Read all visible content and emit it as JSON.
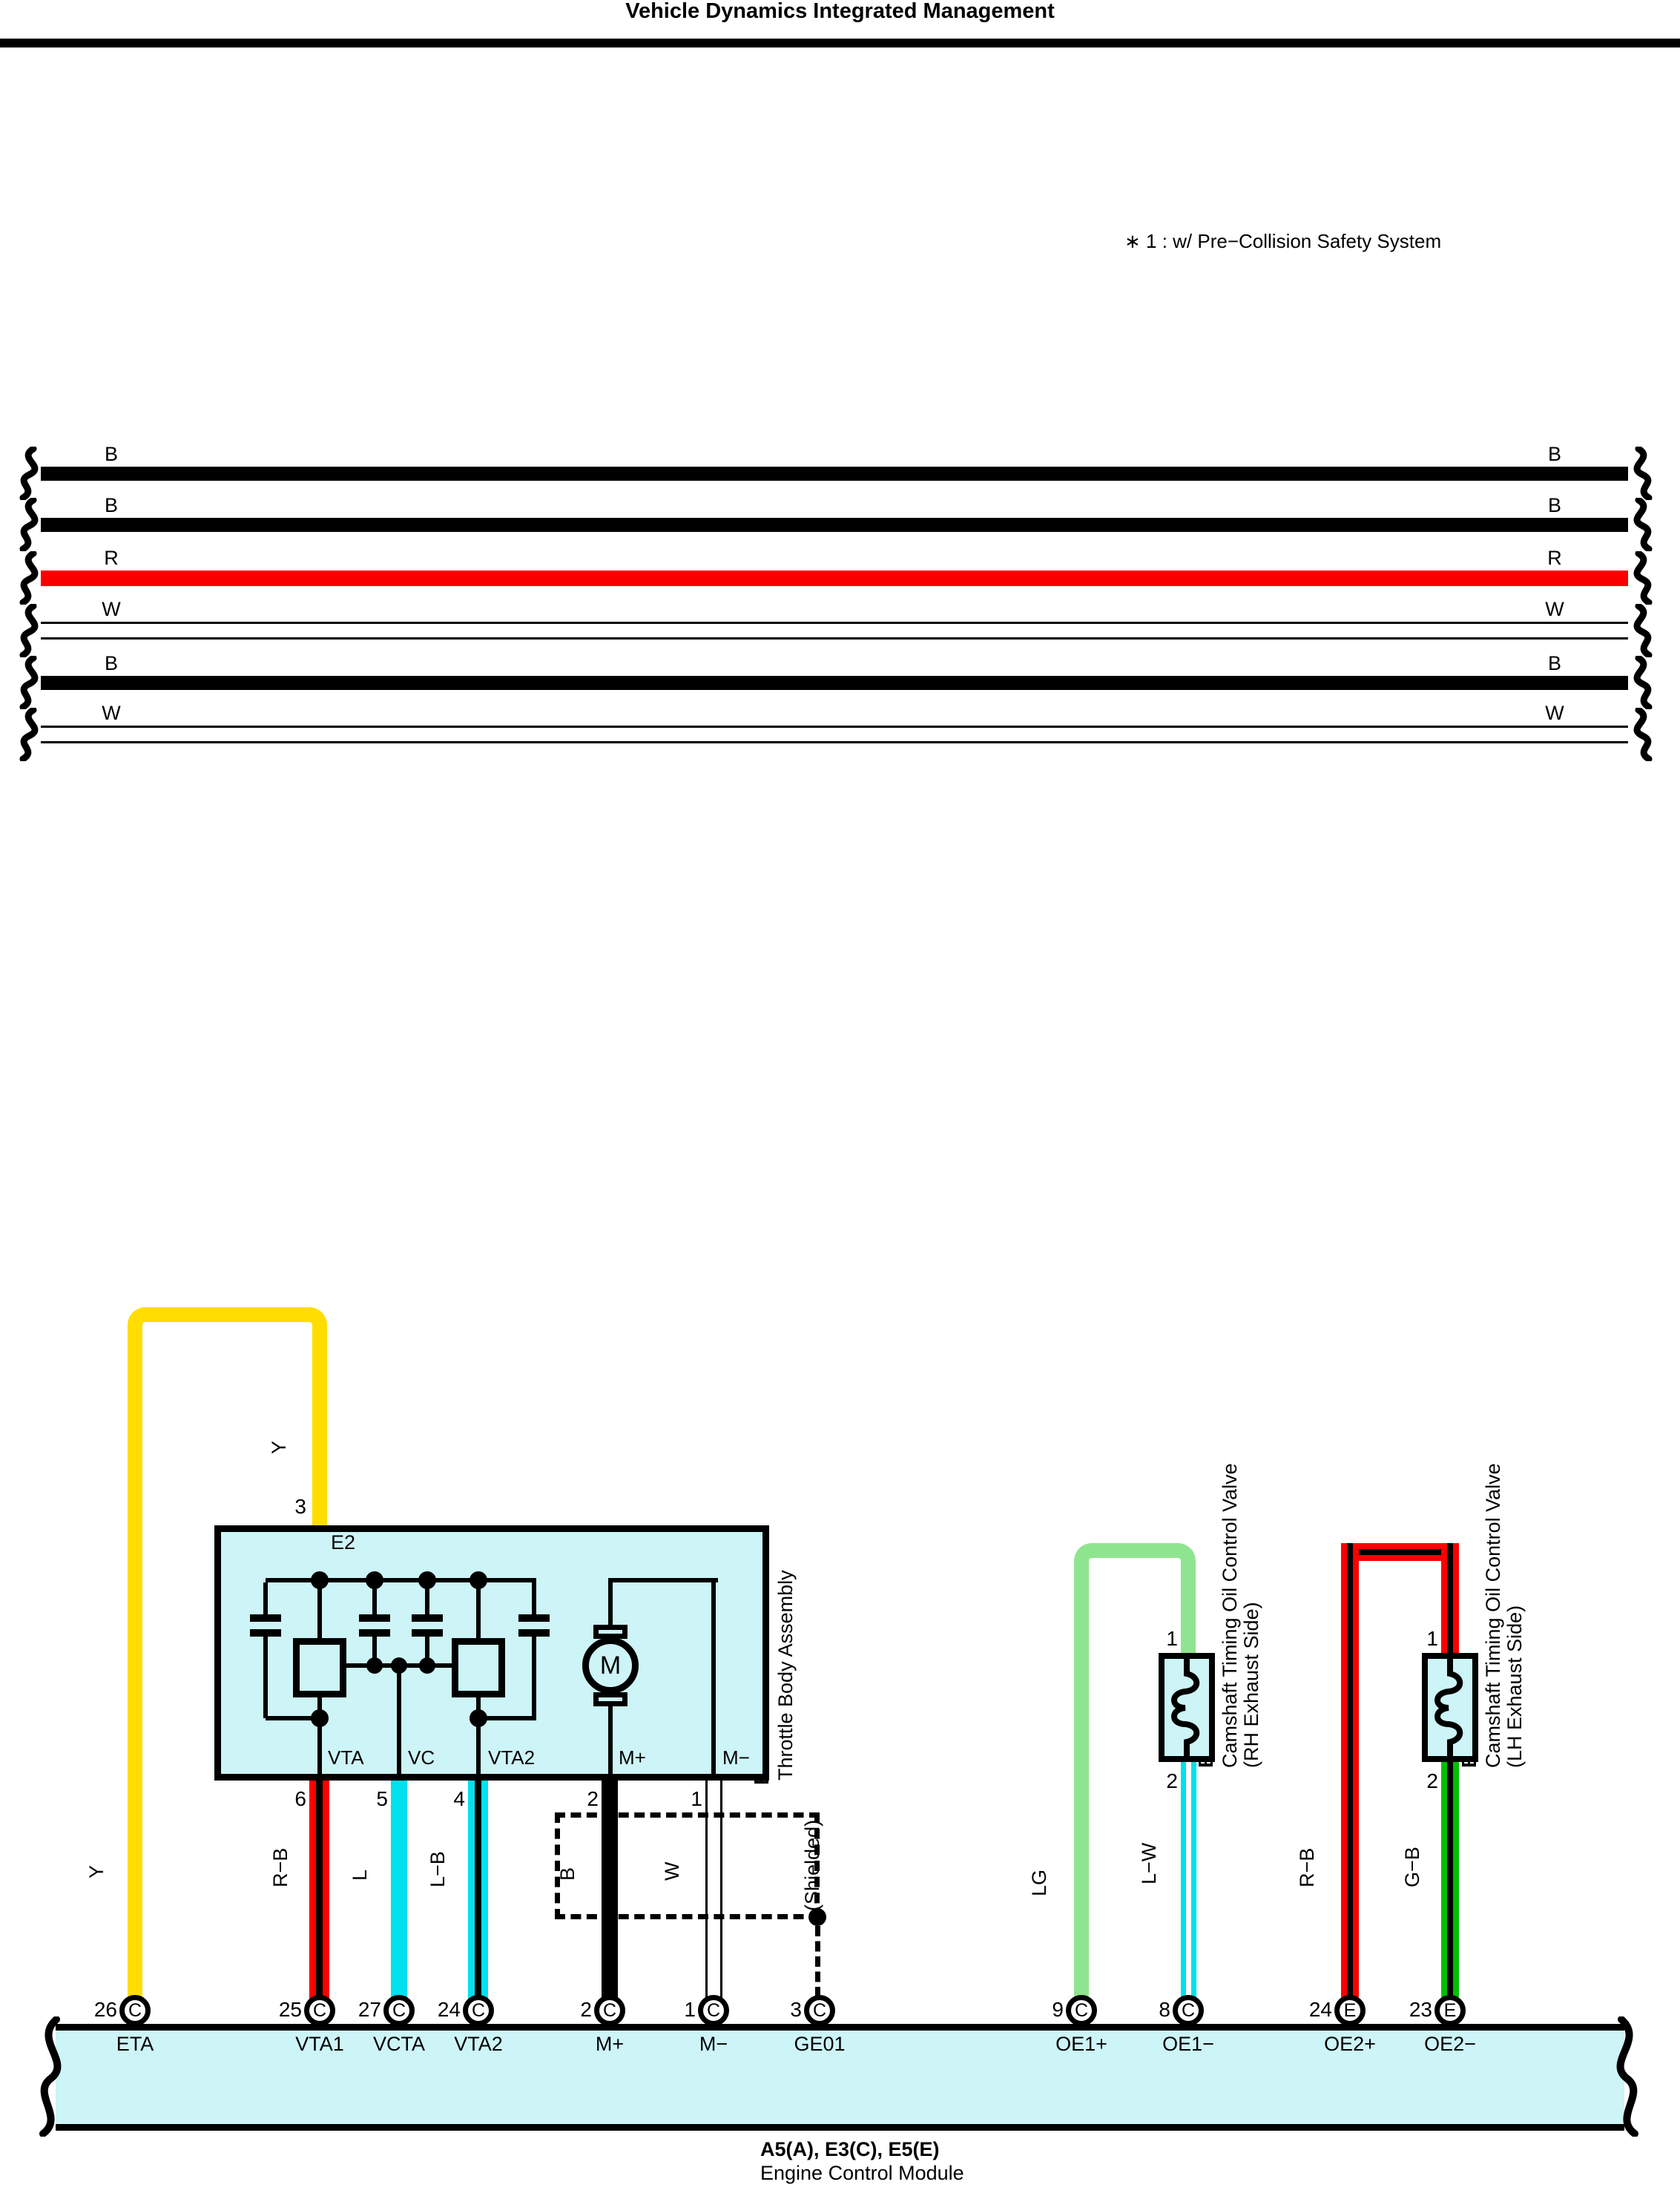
{
  "header": {
    "title": "Vehicle Dynamics Integrated Management"
  },
  "note": "∗ 1 : w/ Pre−Collision Safety System",
  "colors": {
    "black": "#000000",
    "red": "#FA0000",
    "yellow": "#FFDD00",
    "blue_cyan": "#00E0EE",
    "light_green": "#8FE58F",
    "green": "#00BE00",
    "component_fill": "#CDF4F6",
    "white": "#FFFFFF"
  },
  "trunk_wires": [
    {
      "left_label": "B",
      "right_label": "B",
      "code": "B"
    },
    {
      "left_label": "B",
      "right_label": "B",
      "code": "B"
    },
    {
      "left_label": "R",
      "right_label": "R",
      "code": "R"
    },
    {
      "left_label": "W",
      "right_label": "W",
      "code": "W"
    },
    {
      "left_label": "B",
      "right_label": "B",
      "code": "B"
    },
    {
      "left_label": "W",
      "right_label": "W",
      "code": "W"
    }
  ],
  "throttle_body": {
    "connector_code": "E2",
    "component_code": "E17",
    "component_name": "Throttle Body Assembly",
    "motor_label": "M",
    "top_pin": {
      "number": "3",
      "wire": "Y"
    },
    "eta_wire": {
      "label": "Y"
    },
    "terminals": [
      {
        "name": "VTA",
        "pin": "6",
        "wire": "R−B"
      },
      {
        "name": "VC",
        "pin": "5",
        "wire": "L"
      },
      {
        "name": "VTA2",
        "pin": "4",
        "wire": "L−B"
      },
      {
        "name": "M+",
        "pin": "2",
        "wire": "B"
      },
      {
        "name": "M−",
        "pin": "1",
        "wire": "W"
      }
    ],
    "shield_label": "(Shielded)"
  },
  "valves": [
    {
      "code": "E21",
      "name": "Camshaft Timing Oil Control Valve",
      "side": "(RH Exhaust Side)",
      "top_pin": "1",
      "bottom_pin": "2",
      "top_wire": "LG",
      "bottom_wire": "L−W"
    },
    {
      "code": "E31",
      "name": "Camshaft Timing Oil Control Valve",
      "side": "(LH Exhaust Side)",
      "top_pin": "1",
      "bottom_pin": "2",
      "top_wire": "R−B",
      "bottom_wire": "G−B"
    }
  ],
  "ecm": {
    "connectors": [
      {
        "pin": "26",
        "letter": "C",
        "terminal": "ETA"
      },
      {
        "pin": "25",
        "letter": "C",
        "terminal": "VTA1"
      },
      {
        "pin": "27",
        "letter": "C",
        "terminal": "VCTA"
      },
      {
        "pin": "24",
        "letter": "C",
        "terminal": "VTA2"
      },
      {
        "pin": "2",
        "letter": "C",
        "terminal": "M+"
      },
      {
        "pin": "1",
        "letter": "C",
        "terminal": "M−"
      },
      {
        "pin": "3",
        "letter": "C",
        "terminal": "GE01"
      },
      {
        "pin": "9",
        "letter": "C",
        "terminal": "OE1+"
      },
      {
        "pin": "8",
        "letter": "C",
        "terminal": "OE1−"
      },
      {
        "pin": "24",
        "letter": "E",
        "terminal": "OE2+"
      },
      {
        "pin": "23",
        "letter": "E",
        "terminal": "OE2−"
      }
    ],
    "caption_line1": "A5(A), E3(C), E5(E)",
    "caption_line2": "Engine Control Module"
  }
}
